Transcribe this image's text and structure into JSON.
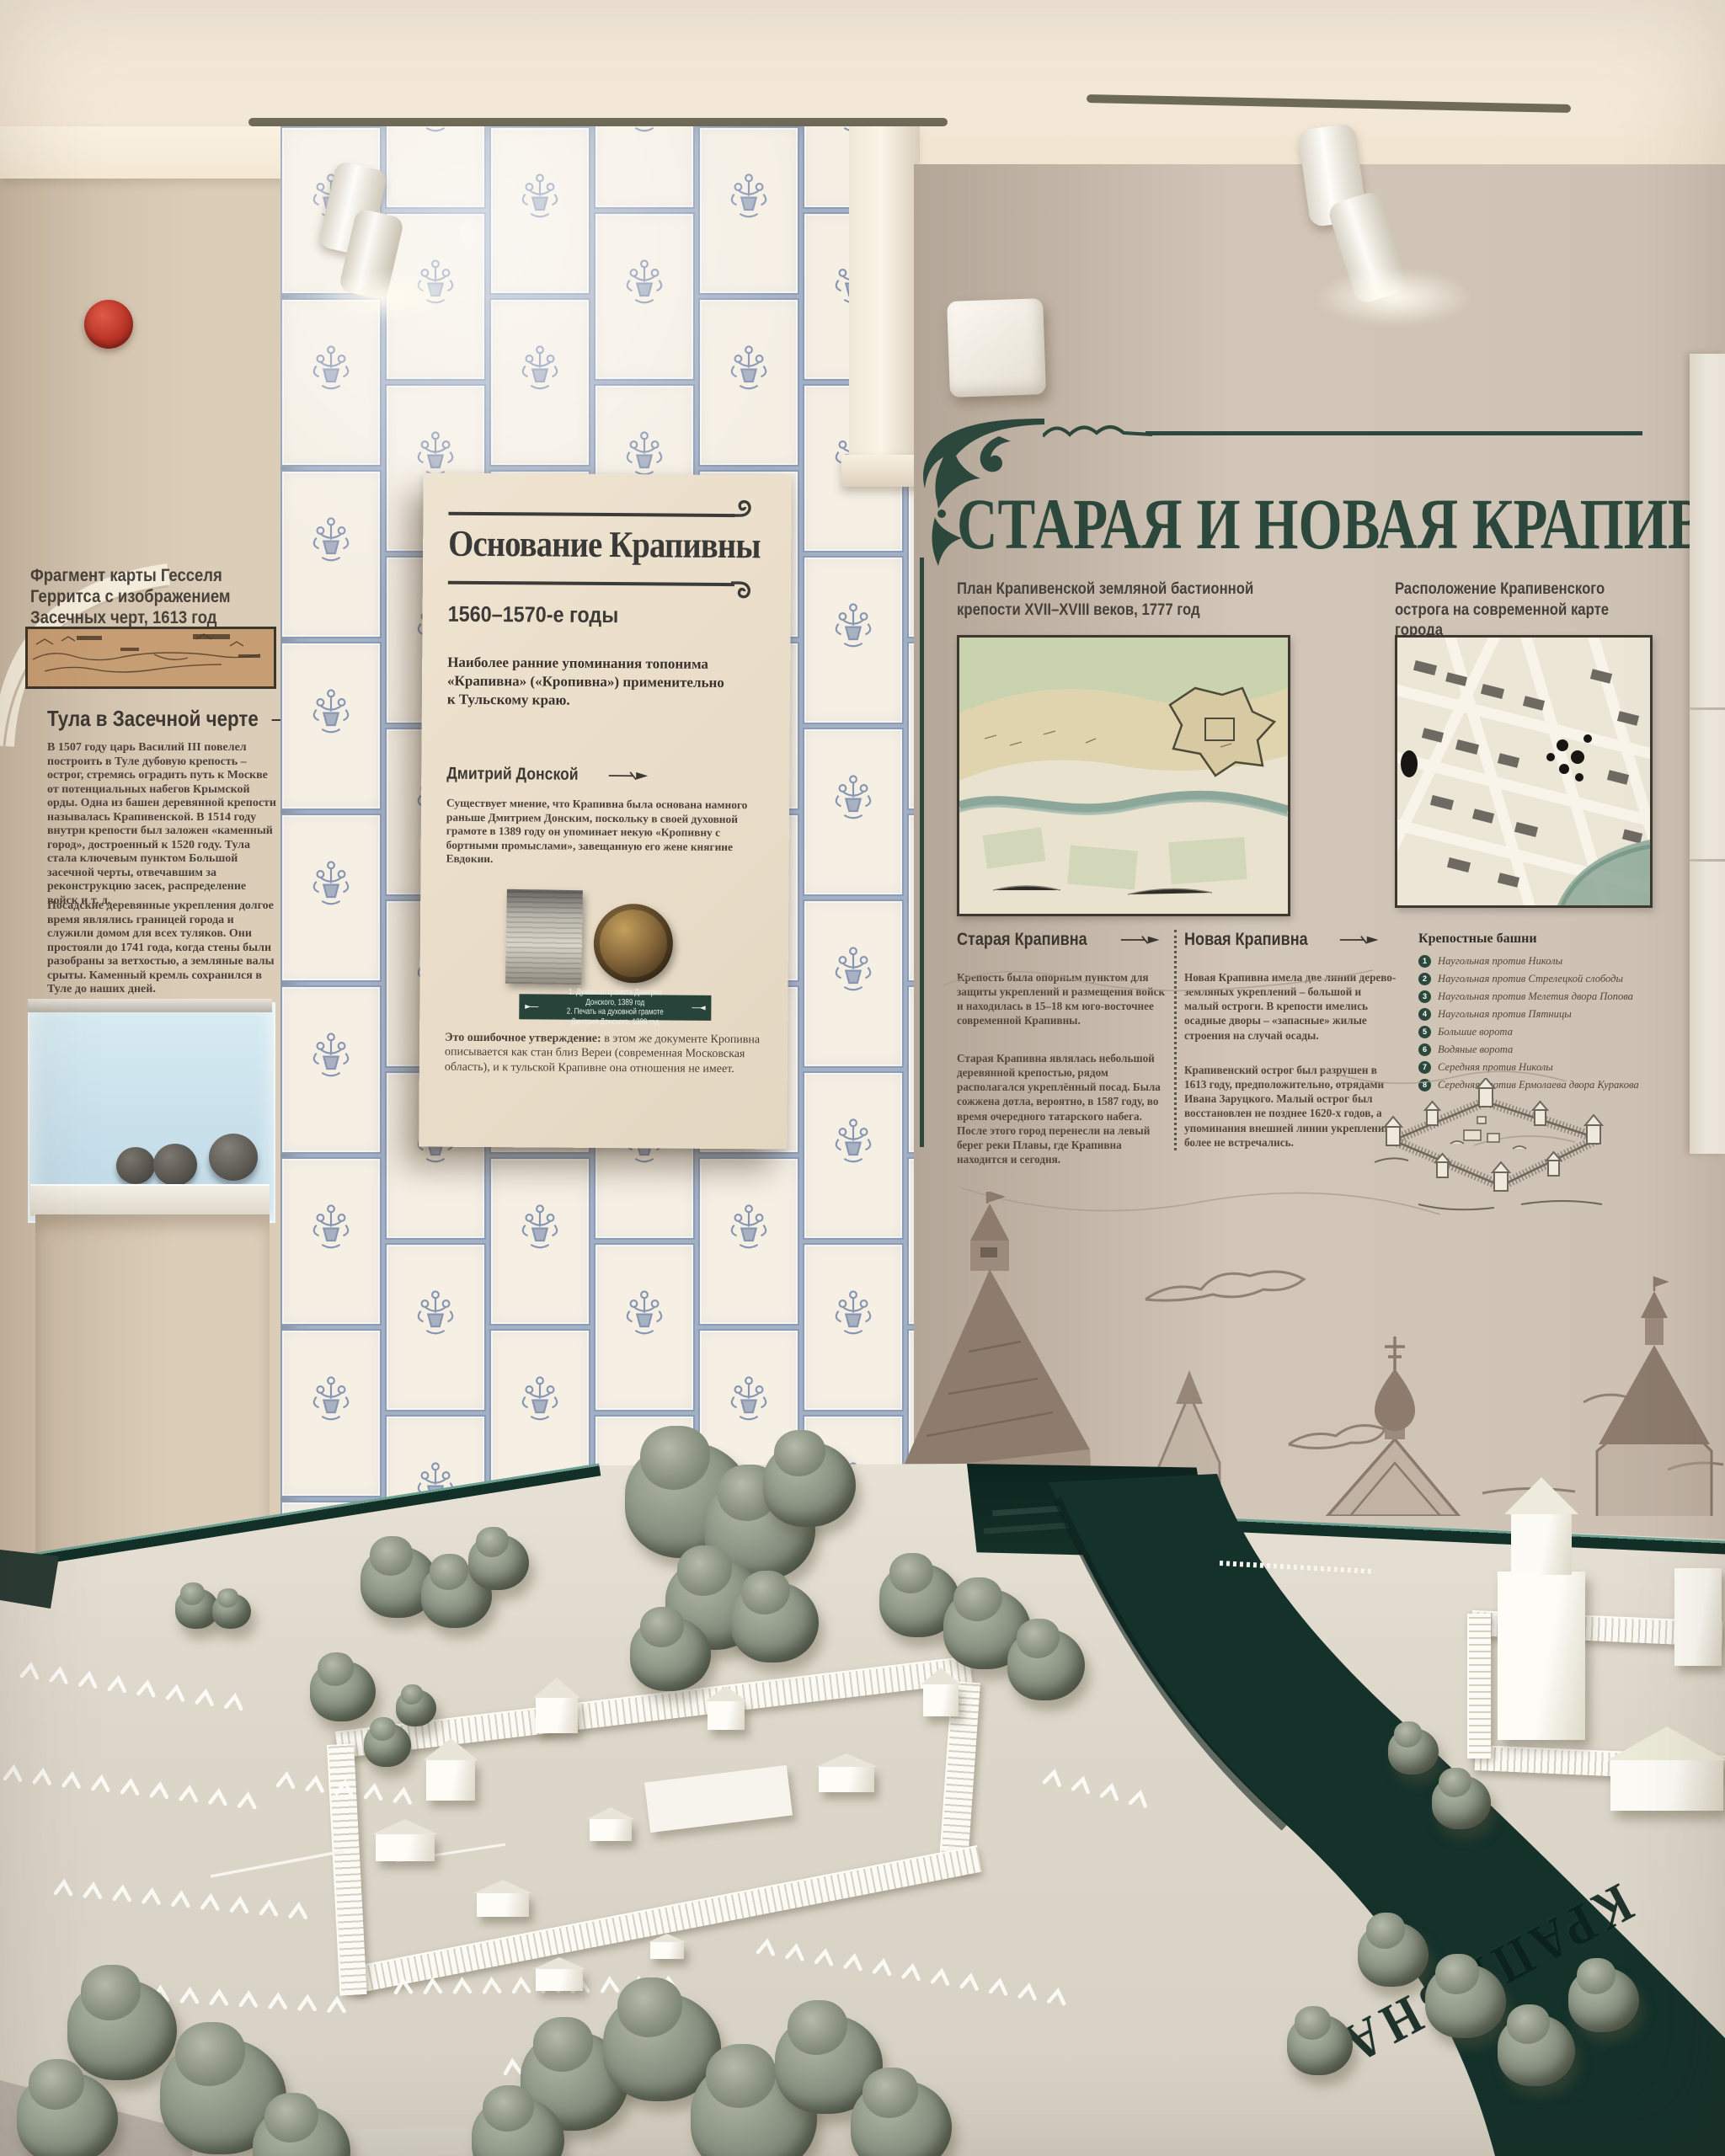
{
  "colors": {
    "accent_green": "#2c473c",
    "tile_blue": "#6b7fa6",
    "panel_cream": "#e9decb",
    "wall_beige": "#d8c9b5",
    "river_dark": "#14312a",
    "alarm_red": "#c23b2e"
  },
  "left_wall_panel": {
    "caption": "Фрагмент карты Гесселя Герритса с изображением Засечных черт, 1613 год",
    "heading": "Тула в Засечной черте",
    "paragraphs": [
      "В 1507 году царь Василий III повелел построить в Туле дубовую крепость – острог, стремясь оградить путь к Москве от потенциальных набегов Крымской орды. Одна из башен деревянной крепости называлась Крапивенской. В 1514 году внутри крепости был заложен «каменный город», достроенный к 1520 году. Тула стала ключевым пунктом Большой засечной черты, отвечавшим за реконструкцию засек, распределение войск и т. д.",
      "Посадские деревянные укрепления долгое время являлись границей города и служили домом для всех туляков. Они простояли до 1741 года, когда стены были разобраны за ветхостью, а земляные валы срыты. Каменный кремль сохранился в Туле до наших дней."
    ]
  },
  "center_panel": {
    "title": "Основание Крапивны",
    "subtitle": "1560–1570-е годы",
    "lead": "Наиболее ранние упоминания топонима «Крапивна» («Кропивна») применительно к Тульскому краю.",
    "section_heading": "Дмитрий Донской",
    "body": "Существует мнение, что Крапивна была основана намного раньше Дмитрием Донским, поскольку в своей духовной грамоте в 1389 году он упоминает некую «Кропивну с бортными промыслами», завещанную его жене княгине Евдокии.",
    "artifact_caption_line1": "1. Духовная грамота Дмитрия Донского, 1389 год",
    "artifact_caption_line2": "2. Печать на духовной грамоте Дмитрия Донского, 1389 год",
    "footnote_bold": "Это ошибочное утверждение:",
    "footnote_rest": " в этом же документе Кропивна описывается как стан близ Вереи (современная Московская область), и к тульской Крапивне она отношения не имеет."
  },
  "right_panel": {
    "title": "СТАРАЯ И НОВАЯ КРАПИВНА",
    "left_map_caption": "План Крапивенской земляной бастионной крепости XVII–XVIII веков, 1777 год",
    "right_map_caption": "Расположение Крапивенского острога на современной карте города",
    "col_old": {
      "heading": "Старая Крапивна",
      "paragraphs": [
        "Крепость была опорным пунктом для защиты укреплений и размещения войск и находилась в 15–18 км юго-восточнее современной Крапивны.",
        "Старая Крапивна являлась небольшой деревянной крепостью, рядом располагался укреплённый посад. Была сожжена дотла, вероятно, в 1587 году, во время очередного татарского набега. После этого город перенесли на левый берег реки Плавы, где Крапивна находится и сегодня."
      ]
    },
    "col_new": {
      "heading": "Новая Крапивна",
      "paragraphs": [
        "Новая Крапивна имела две линии дерево-земляных укреплений – большой и малый остроги. В крепости имелись осадные дворы – «запасные» жилые строения на случай осады.",
        "Крапивенский острог был разрушен в 1613 году, предположительно, отрядами Ивана Заруцкого. Малый острог был восстановлен не позднее 1620-х годов, а упоминания внешней линии укреплений более не встречались."
      ]
    },
    "legend": {
      "title": "Крепостные башни",
      "nums": [
        "1",
        "2",
        "3",
        "4",
        "5",
        "6",
        "7",
        "8"
      ],
      "items": [
        "Наугольная против Николы",
        "Наугольная против Стрелецкой слободы",
        "Наугольная против Мелетия двора Попова",
        "Наугольная против Пятницы",
        "Большие ворота",
        "Водяные ворота",
        "Середняя против Николы",
        "Середняя против Ермолаева двора Куракова"
      ]
    }
  },
  "model": {
    "river_label": "КРАПИВНА"
  }
}
